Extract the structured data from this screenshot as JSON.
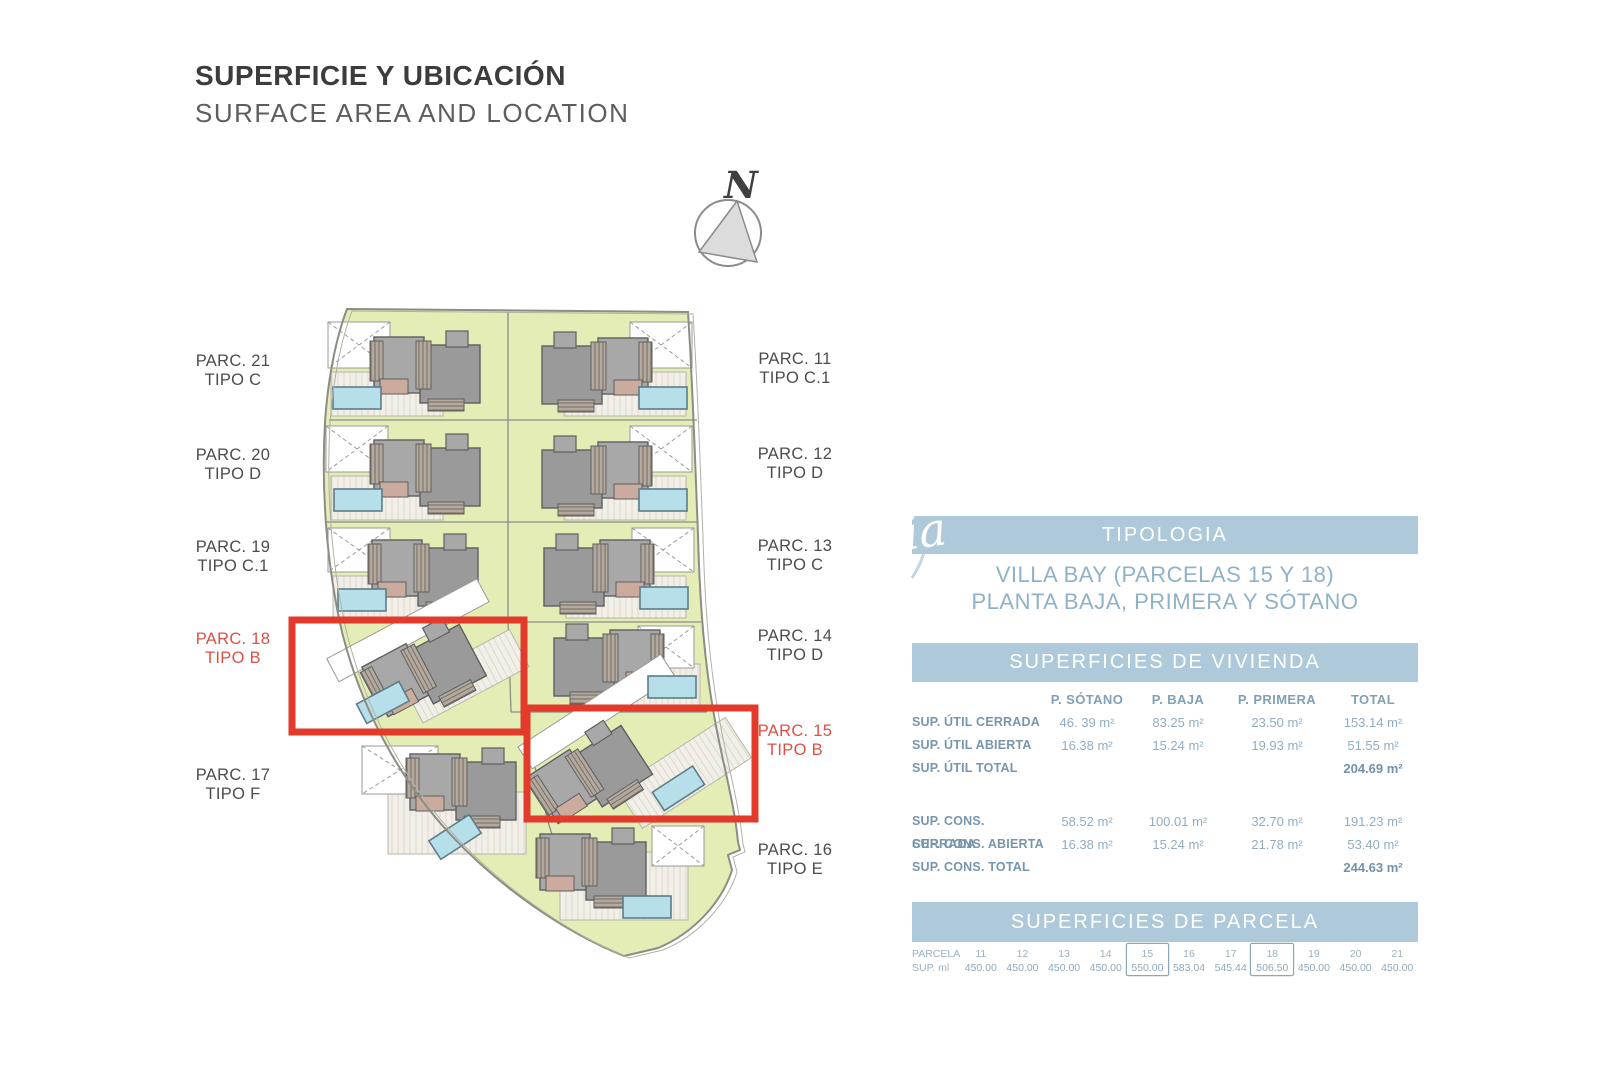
{
  "colors": {
    "accent_bar": "#aecada",
    "accent_text": "#8fb2c6",
    "table_value_text": "#92adc0",
    "table_label_text": "#7796ad",
    "highlight_red_box": "#e23a2b",
    "highlight_red_label": "#dd5145",
    "lawn_green": "#e3edb5",
    "building_gray": "#9a9a9a",
    "pool_blue": "#b6dfea"
  },
  "header": {
    "title": "SUPERFICIE Y UBICACIÓN",
    "subtitle": "SURFACE AREA AND LOCATION"
  },
  "compass": {
    "north_label": "N"
  },
  "watermark": {
    "script_text": "ia"
  },
  "site_plan": {
    "labels": [
      {
        "name": "PARC. 21",
        "tipo": "TIPO C",
        "red": false
      },
      {
        "name": "PARC. 20",
        "tipo": "TIPO D",
        "red": false
      },
      {
        "name": "PARC. 19",
        "tipo": "TIPO C.1",
        "red": false
      },
      {
        "name": "PARC. 18",
        "tipo": "TIPO B",
        "red": true
      },
      {
        "name": "PARC. 17",
        "tipo": "TIPO F",
        "red": false
      },
      {
        "name": "PARC. 11",
        "tipo": "TIPO C.1",
        "red": false
      },
      {
        "name": "PARC. 12",
        "tipo": "TIPO D",
        "red": false
      },
      {
        "name": "PARC. 13",
        "tipo": "TIPO C",
        "red": false
      },
      {
        "name": "PARC. 14",
        "tipo": "TIPO D",
        "red": false
      },
      {
        "name": "PARC. 15",
        "tipo": "TIPO B",
        "red": true
      },
      {
        "name": "PARC. 16",
        "tipo": "TIPO E",
        "red": false
      }
    ]
  },
  "panel": {
    "tipologia_header": "TIPOLOGIA",
    "tipologia_line1": "VILLA BAY (PARCELAS 15 Y 18)",
    "tipologia_line2": "PLANTA BAJA, PRIMERA Y SÓTANO",
    "vivienda_header": "SUPERFICIES DE VIVIENDA",
    "vivienda_columns": [
      "P. SÓTANO",
      "P. BAJA",
      "P. PRIMERA",
      "TOTAL"
    ],
    "vivienda_rows": [
      {
        "label": "SUP. ÚTIL CERRADA",
        "values": [
          "46. 39 m²",
          "83.25 m²",
          "23.50 m²",
          "153.14 m²"
        ]
      },
      {
        "label": "SUP. ÚTIL ABIERTA",
        "values": [
          "16.38 m²",
          "15.24 m²",
          "19.93 m²",
          "51.55 m²"
        ]
      },
      {
        "label": "SUP. ÚTIL TOTAL",
        "values": [
          "",
          "",
          "",
          "204.69 m²"
        ]
      },
      {
        "label": "SUP. CONS. CERRADA",
        "values": [
          "58.52 m²",
          "100.01 m²",
          "32.70 m²",
          "191.23 m²"
        ]
      },
      {
        "label": "SUP. CONS. ABIERTA",
        "values": [
          "16.38 m²",
          "15.24 m²",
          "21.78 m²",
          "53.40 m²"
        ]
      },
      {
        "label": "SUP. CONS. TOTAL",
        "values": [
          "",
          "",
          "",
          "244.63 m²"
        ]
      }
    ],
    "parcela_header": "SUPERFICIES DE PARCELA",
    "parcela_row_label_1": "PARCELA",
    "parcela_row_label_2": "SUP. ml",
    "parcela_cells": [
      {
        "n": "11",
        "v": "450.00",
        "boxed": false
      },
      {
        "n": "12",
        "v": "450.00",
        "boxed": false
      },
      {
        "n": "13",
        "v": "450.00",
        "boxed": false
      },
      {
        "n": "14",
        "v": "450.00",
        "boxed": false
      },
      {
        "n": "15",
        "v": "550.00",
        "boxed": true
      },
      {
        "n": "16",
        "v": "583.04",
        "boxed": false
      },
      {
        "n": "17",
        "v": "545.44",
        "boxed": false
      },
      {
        "n": "18",
        "v": "506.50",
        "boxed": true
      },
      {
        "n": "19",
        "v": "450.00",
        "boxed": false
      },
      {
        "n": "20",
        "v": "450.00",
        "boxed": false
      },
      {
        "n": "21",
        "v": "450.00",
        "boxed": false
      }
    ]
  }
}
